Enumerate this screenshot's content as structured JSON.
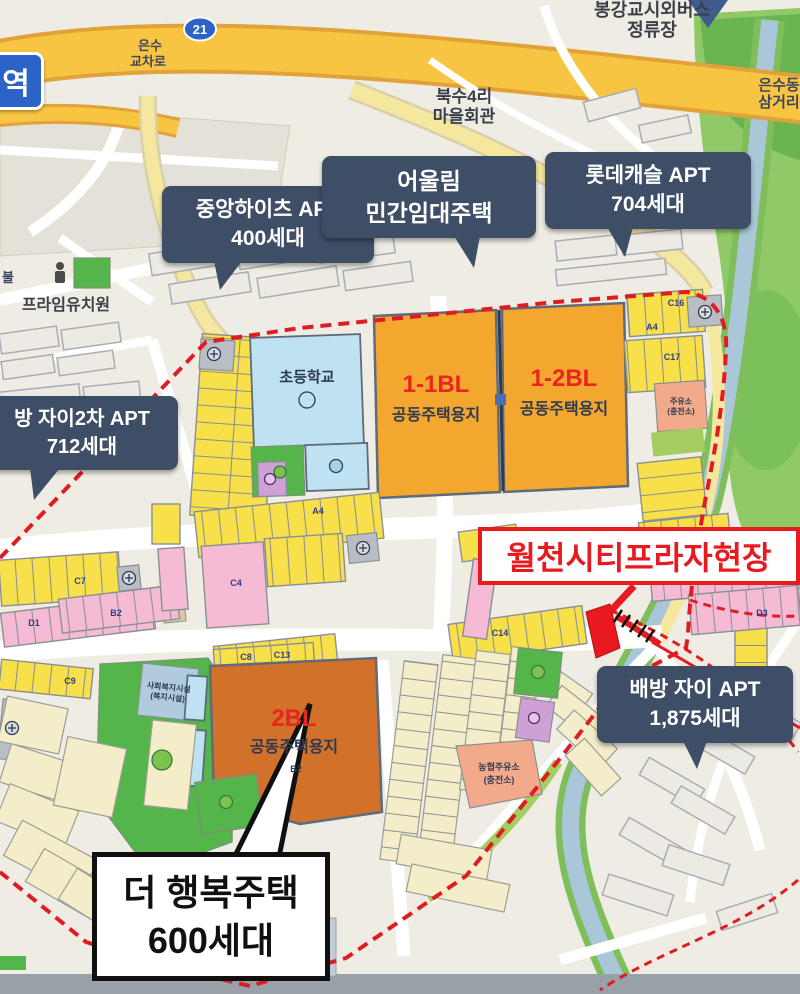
{
  "colors": {
    "banner_red": "#E8191F",
    "callout_navy": "#3E4E66",
    "boundary_red": "#E01B22",
    "block_orange": "#F4A72E",
    "block_orange_dark": "#D2712A",
    "parcel_yellow": "#F7E049",
    "school_blue": "#BFE2F2",
    "park_green": "#54B64A",
    "route_shield_blue": "#2B63C6"
  },
  "signs": {
    "station": "역",
    "route_shield": "21"
  },
  "roads": {
    "eunsu_ic_1": "은수",
    "eunsu_ic_2": "교차로",
    "samgeori_1": "은수동",
    "samgeori_2": "삼거리",
    "buksu_1": "북수4리",
    "buksu_2": "마을회관",
    "bus_1": "봉강교시외버스",
    "bus_2": "정류장",
    "cut_label": "불"
  },
  "places": {
    "kindergarten": "프라임유치원",
    "school": "초등학교",
    "school_bottom": "초등학교",
    "welfare_1": "사회복지시설",
    "welfare_2": "(복지시설)",
    "gas_e_1": "주유소",
    "gas_e_2": "(충전소)",
    "gas_s_1": "농협주유소",
    "gas_s_2": "(충전소)"
  },
  "blocks": {
    "b11_code": "1-1BL",
    "b11_use": "공동주택용지",
    "b12_code": "1-2BL",
    "b12_use": "공동주택용지",
    "b2_code": "2BL",
    "b2_use": "공동주택용지",
    "b2_sub": "B2"
  },
  "callouts": [
    {
      "line1": "중앙하이츠 APT",
      "line2": "400세대"
    },
    {
      "line1": "어울림",
      "line2": "민간임대주택"
    },
    {
      "line1": "롯데캐슬 APT",
      "line2": "704세대"
    },
    {
      "line1": "방 자이2차 APT",
      "line2": "712세대"
    },
    {
      "line1": "배방 자이 APT",
      "line2": "1,875세대"
    }
  ],
  "banner": {
    "text": "월천시티프라자현장"
  },
  "happy_house": {
    "line1": "더 행복주택",
    "line2": "600세대"
  },
  "parcel_codes": [
    {
      "code": "C16",
      "x": 676,
      "y": 306
    },
    {
      "code": "C17",
      "x": 672,
      "y": 360
    },
    {
      "code": "A4",
      "x": 318,
      "y": 514
    },
    {
      "code": "A4",
      "x": 652,
      "y": 330
    },
    {
      "code": "C7",
      "x": 80,
      "y": 584
    },
    {
      "code": "C4",
      "x": 236,
      "y": 586
    },
    {
      "code": "C4",
      "x": 716,
      "y": 576
    },
    {
      "code": "D3",
      "x": 762,
      "y": 616
    },
    {
      "code": "D1",
      "x": 34,
      "y": 626
    },
    {
      "code": "B2",
      "x": 116,
      "y": 616
    },
    {
      "code": "C8",
      "x": 246,
      "y": 660
    },
    {
      "code": "C9",
      "x": 70,
      "y": 684
    },
    {
      "code": "C13",
      "x": 282,
      "y": 658
    },
    {
      "code": "C14",
      "x": 500,
      "y": 636
    }
  ]
}
